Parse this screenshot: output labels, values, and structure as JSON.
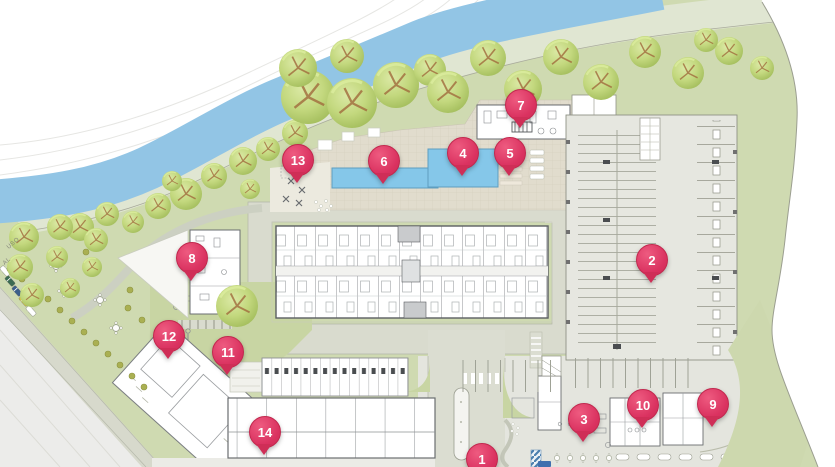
{
  "map": {
    "type": "residential-site-plan",
    "markers": [
      {
        "label": "1"
      },
      {
        "label": "2"
      },
      {
        "label": "3"
      },
      {
        "label": "4"
      },
      {
        "label": "5"
      },
      {
        "label": "6"
      },
      {
        "label": "7"
      },
      {
        "label": "8"
      },
      {
        "label": "9"
      },
      {
        "label": "10"
      },
      {
        "label": "11"
      },
      {
        "label": "12"
      },
      {
        "label": "13"
      },
      {
        "label": "14"
      }
    ],
    "ground_labels": [
      {
        "text": "USO"
      },
      {
        "text": "AL"
      }
    ]
  },
  "colors": {
    "pin": "#da3260",
    "pin_border": "#c2284e",
    "river": "#92c5e5",
    "grass": "#cfdab1",
    "riparian": "#e0e6d2",
    "deck": "#e1dccd",
    "parking": "#e6e7e0",
    "road": "#d9dbce",
    "tree": "#c2d87f",
    "pool": "#85c7e9",
    "building_wall": "#5b5e62"
  }
}
